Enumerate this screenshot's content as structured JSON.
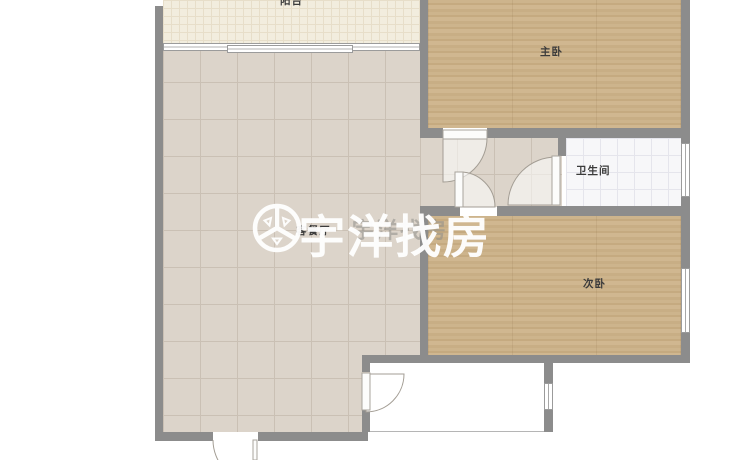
{
  "meta": {
    "type": "real-estate floor plan",
    "watermark_brand": "宇洋找房"
  },
  "rooms": {
    "balcony": {
      "label": "阳台"
    },
    "living_dining": {
      "label": "客餐厅"
    },
    "master_bedroom": {
      "label": "主卧"
    },
    "bathroom": {
      "label": "卫生间"
    },
    "second_bedroom": {
      "label": "次卧"
    }
  },
  "watermark": {
    "brand": "宇洋找房",
    "brand_echo": "宇洋找房"
  },
  "colors": {
    "wall": "#8c8c8c",
    "wood_floor": "#c9b189",
    "tile_floor": "#dcd4ca",
    "balcony_floor": "#f2edde",
    "bath_floor": "#f7f7f9",
    "watermark": "#ffffff"
  }
}
